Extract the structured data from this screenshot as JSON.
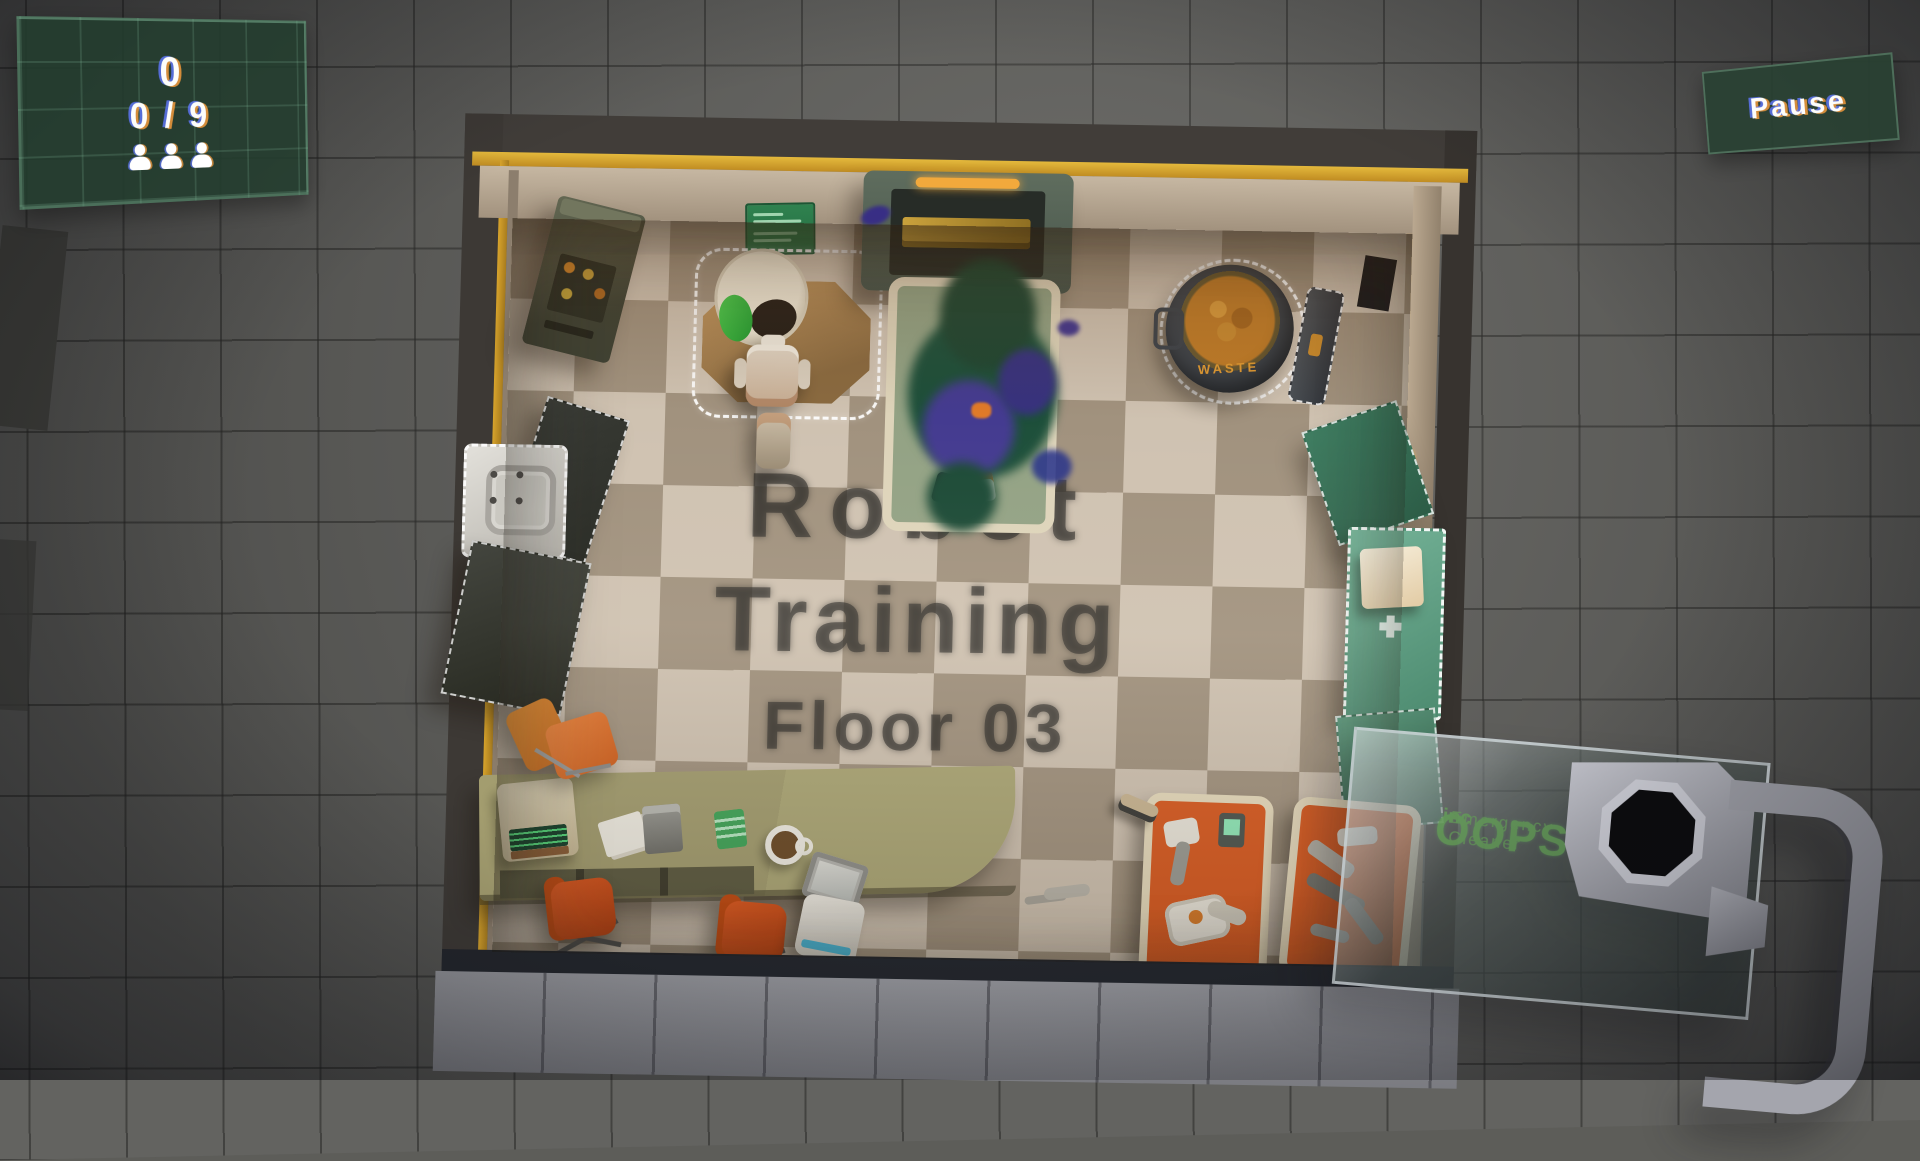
{
  "hud": {
    "score": "0",
    "progress": "0 / 9",
    "crew_count": 3,
    "pause_label": "Pause"
  },
  "floor_label": {
    "line1": "Robot",
    "line2": "Training",
    "line3": "Floor 03"
  },
  "room": {
    "name": "Robot Training Floor 03",
    "waste_label": "WASTE"
  },
  "device": {
    "brand": "OOPS!",
    "suffix": "inc",
    "tagline": "Emergency Cleaner"
  },
  "colors": {
    "background_tile": "#636360",
    "hud_panel": "#223c2e",
    "pause_panel": "#284032",
    "gold_trim": "#d8a42c",
    "floor_light": "#cfc2b1",
    "floor_dark": "#a1927e",
    "bed_orange": "#d85a20",
    "sign_green": "#2f824f",
    "logo_green": "#649e58",
    "goo_green": "#1d4f3a",
    "goo_purple": "#49399a"
  }
}
